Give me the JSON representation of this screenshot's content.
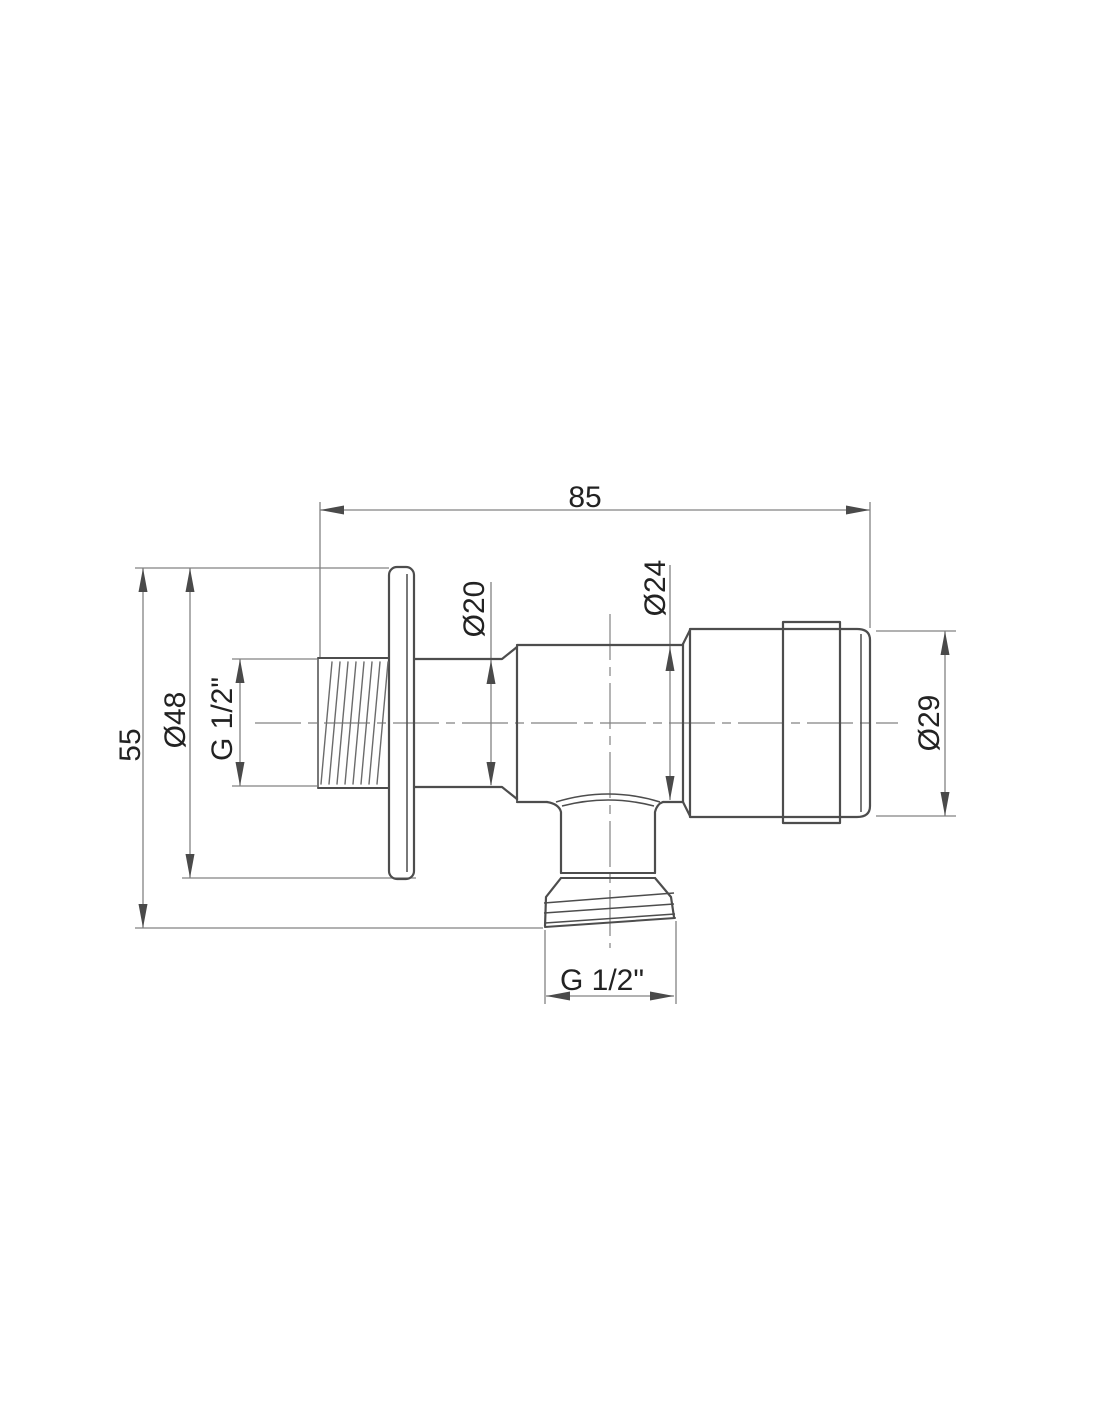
{
  "page": {
    "background": "#ffffff"
  },
  "drawing": {
    "dimensions": {
      "overall_length": "85",
      "overall_height": "55",
      "flange_diameter": "Ø48",
      "inlet_thread_size": "G 1/2\"",
      "neck_diameter": "Ø20",
      "body_diameter": "Ø24",
      "handle_diameter": "Ø29",
      "outlet_thread_size": "G 1/2\""
    },
    "colors": {
      "object_line": "#4d4d4d",
      "thin_line": "#828282",
      "hatch_line": "#6b6b6b",
      "arrow": "#4a4a4a",
      "text": "#222222",
      "background": "#ffffff"
    }
  }
}
